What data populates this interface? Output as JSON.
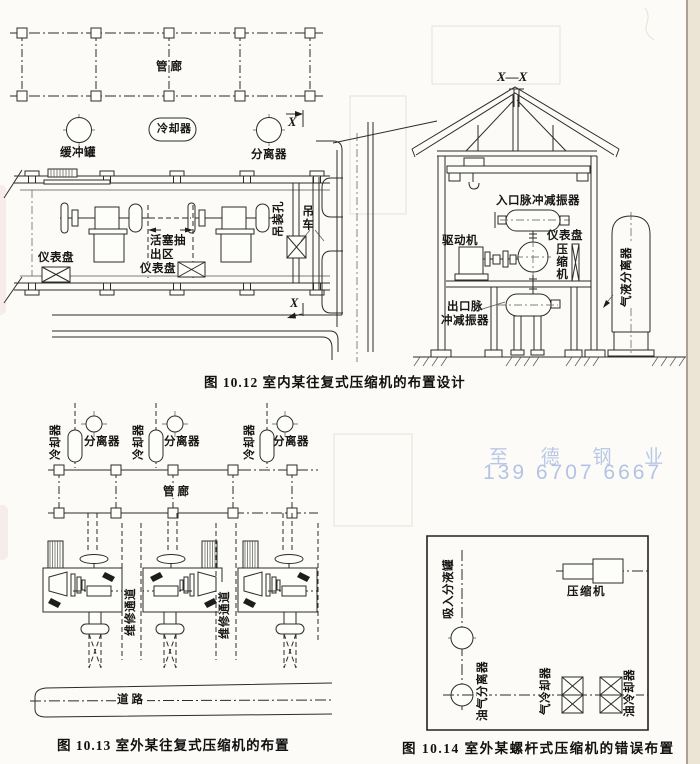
{
  "watermark": {
    "company": "至 德 钢 业",
    "phone": "139 6707 6667"
  },
  "fig1012": {
    "caption": "图 10.12  室内某往复式压缩机的布置设计",
    "plan": {
      "pipe_rack": "管廊",
      "buffer_tank": "缓冲罐",
      "cooler": "冷却器",
      "separator": "分离器",
      "section_mark": "X",
      "instrument_panel": "仪表盘",
      "piston_zone_line1": "活塞抽",
      "piston_zone_line2": "出区",
      "lifting_hole": "吊装孔",
      "crane": "吊车"
    },
    "section": {
      "title": "X—X",
      "inlet_damper": "入口脉冲减振器",
      "driver": "驱动机",
      "instrument_panel": "仪表盘",
      "compressor": "压缩机",
      "outlet_damper_line1": "出口脉",
      "outlet_damper_line2": "冲减振器",
      "gas_liquid_separator": "气液分离器"
    }
  },
  "fig1013": {
    "caption": "图 10.13  室外某往复式压缩机的布置",
    "cooler": "冷却器",
    "separator": "分离器",
    "pipe_rack": "管廊",
    "maintenance_passage": "维修通道",
    "road": "道路"
  },
  "fig1014": {
    "caption": "图 10.14  室外某螺杆式压缩机的错误布置",
    "suction_tank": "吸入分液罐",
    "compressor": "压缩机",
    "oil_gas_separator": "油气分离器",
    "gas_cooler": "气冷却器",
    "oil_cooler": "油冷却器"
  }
}
